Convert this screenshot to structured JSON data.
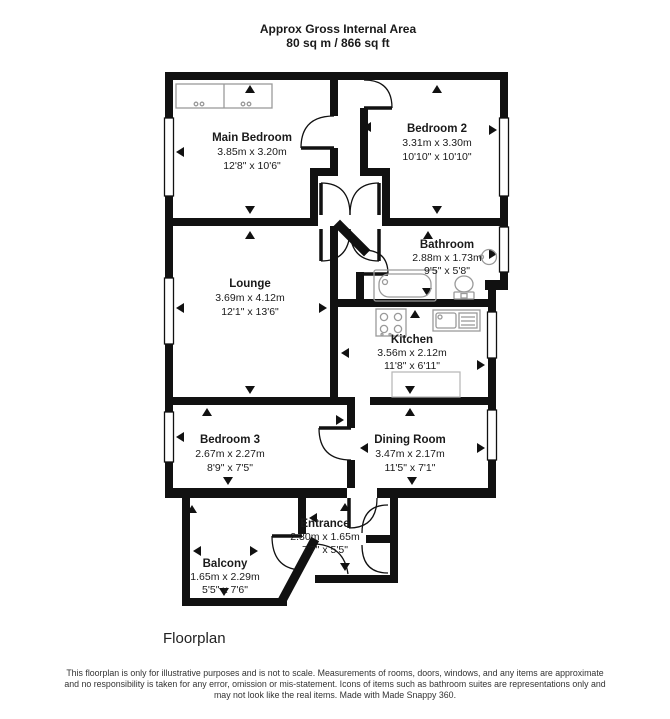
{
  "header": {
    "line1": "Approx Gross Internal Area",
    "line2": "80 sq m / 866 sq ft"
  },
  "rooms": {
    "main_bedroom": {
      "name": "Main Bedroom",
      "metric": "3.85m x 3.20m",
      "imperial": "12'8\" x 10'6\""
    },
    "bedroom2": {
      "name": "Bedroom 2",
      "metric": "3.31m x 3.30m",
      "imperial": "10'10\" x 10'10\""
    },
    "bathroom": {
      "name": "Bathroom",
      "metric": "2.88m x 1.73m",
      "imperial": "9'5\" x 5'8\""
    },
    "lounge": {
      "name": "Lounge",
      "metric": "3.69m x 4.12m",
      "imperial": "12'1\" x 13'6\""
    },
    "kitchen": {
      "name": "Kitchen",
      "metric": "3.56m x 2.12m",
      "imperial": "11'8\" x 6'11\""
    },
    "dining_room": {
      "name": "Dining Room",
      "metric": "3.47m x 2.17m",
      "imperial": "11'5\" x 7'1\""
    },
    "bedroom3": {
      "name": "Bedroom 3",
      "metric": "2.67m x 2.27m",
      "imperial": "8'9\" x 7'5\""
    },
    "entrance": {
      "name": "Entrance",
      "metric": "2.30m x 1.65m",
      "imperial": "7'7\" x 5'5\""
    },
    "balcony": {
      "name": "Balcony",
      "metric": "1.65m x 2.29m",
      "imperial": "5'5\" x 7'6\""
    }
  },
  "caption": "Floorplan",
  "footer": {
    "line1": "This floorplan is only for illustrative purposes and is not to scale. Measurements of rooms, doors, windows, and any items are approximate",
    "line2": "and no responsibility is taken for any error, omission or mis-statement. Icons of items such as bathroom suites are representations only and",
    "line3": "may not look like the real items. Made with Made Snappy 360."
  },
  "colors": {
    "wall": "#111111",
    "text": "#1a1a1a",
    "fixture": "#9a9a9a"
  }
}
